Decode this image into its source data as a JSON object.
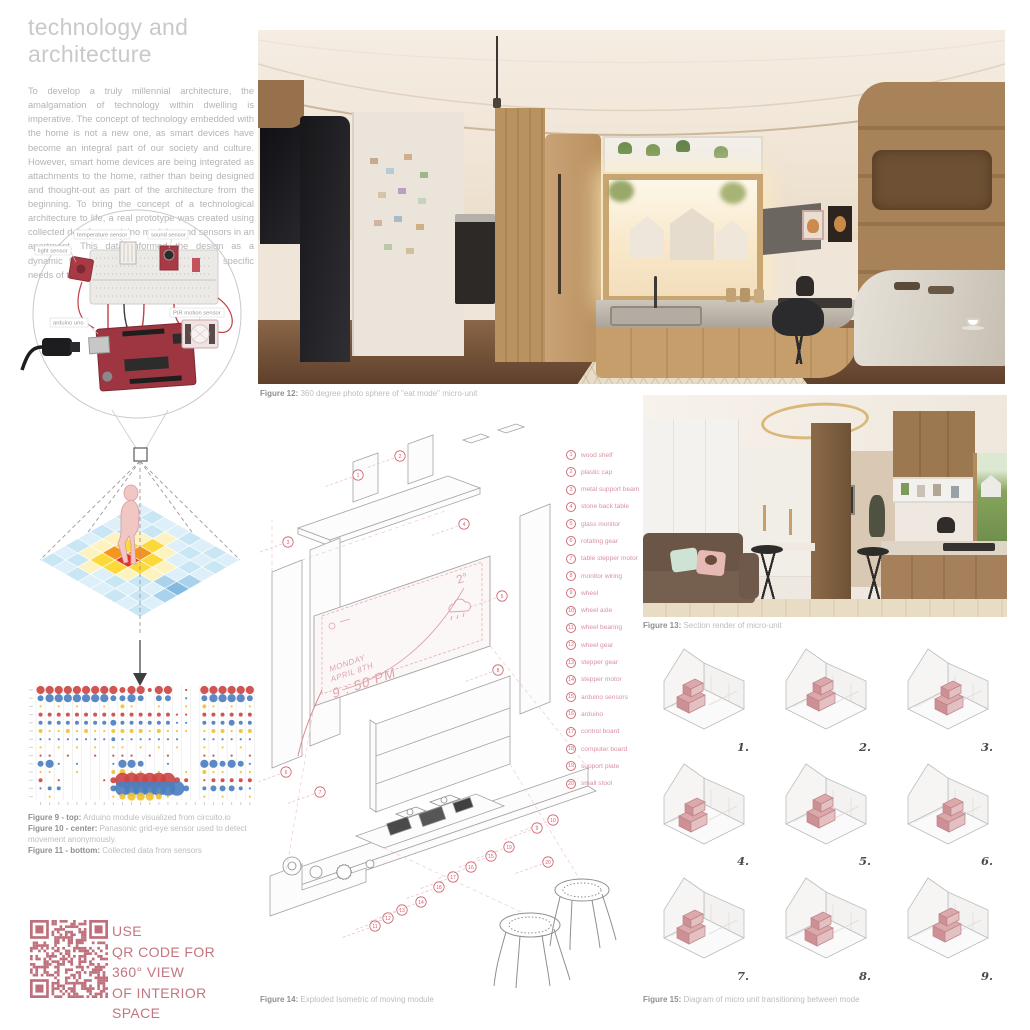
{
  "intro": {
    "title": "technology and architecture",
    "body": "To develop a truly millennial architecture, the amalgamation of technology within dwelling is imperative. The concept of technology embedded with the home is not a new one, as smart devices have become an integral part of our society and culture. However, smart home devices are being integrated as attachments to the home, rather than being designed and thought-out as part of the architecture from the beginning. To bring  the concept of a technological architecture to life, a real prototype was created using collected data from arduino modules and sensors in an apartment. This data informed the design as a dynamic floor plan that responded to the specific needs of the user was developed from it."
  },
  "arduino_diagram": {
    "labels": {
      "light": "light sensor",
      "temperature": "temperature sensor",
      "sound": "sound sensor",
      "board": "arduino uno",
      "pir": "PIR motion sensor"
    }
  },
  "figures": {
    "fig9": {
      "label": "Figure 9 - top:",
      "text": " Arduino module visualized from circuito.io"
    },
    "fig10": {
      "label": "Figure 10 - center:",
      "text": " Panasonic grid-eye sensor used to detect movement anonymously."
    },
    "fig11": {
      "label": "Figure 11 - bottom:",
      "text": " Collected data from sensors"
    },
    "fig12": {
      "label": "Figure 12:",
      "text": " 360 degree photo sphere of \"eat mode\" micro-unit"
    },
    "fig13": {
      "label": "Figure 13:",
      "text": " Section render of micro-unit"
    },
    "fig14": {
      "label": "Figure 14:",
      "text": " Exploded Isometric of moving module"
    },
    "fig15": {
      "label": "Figure 15:",
      "text": " Diagram of micro unit transitioning between mode"
    }
  },
  "exploded": {
    "legend": [
      "wood shelf",
      "plastic cap",
      "metal support beam",
      "stone back table",
      "glass monitor",
      "rotating gear",
      "table stepper motor",
      "monitor wiring",
      "wheel",
      "wheel axle",
      "wheel bearing",
      "wheel gear",
      "stepper gear",
      "stepper motor",
      "arduino sensors",
      "arduino",
      "control board",
      "computer board",
      "support plate",
      "small stool"
    ],
    "monitor": {
      "day": "MONDAY",
      "date": "APRIL 8TH",
      "time": "9 : 50 PM",
      "temp": "2°"
    },
    "accent": "#d0616e"
  },
  "qr": {
    "lines": [
      "USE",
      "QR CODE FOR",
      "360° VIEW",
      "OF INTERIOR",
      "SPACE"
    ],
    "color": "#bf6f7b"
  },
  "unit_grid": {
    "numbers": [
      "1.",
      "2.",
      "3.",
      "4.",
      "5.",
      "6.",
      "7.",
      "8.",
      "9."
    ],
    "module_color": "#dba8ab"
  },
  "chart_data": [
    {
      "type": "heatmap",
      "title": "Grid-eye sensor movement heatmap (Figure 10)",
      "grid_on": true,
      "legend_position": "none",
      "palette": {
        "a": "#ddeff8",
        "b": "#c8e6f4",
        "c": "#a9d3ec",
        "d": "#84b9e0",
        "y": "#fdf3c0",
        "Y": "#fcd93b",
        "o": "#f5941e",
        "r": "#e53228"
      },
      "rows": [
        [
          "a",
          "b",
          "a",
          "a",
          "b",
          "a",
          "b",
          "a"
        ],
        [
          "b",
          "a",
          "b",
          "y",
          "a",
          "b",
          "a",
          "b"
        ],
        [
          "a",
          "b",
          "y",
          "Y",
          "y",
          "a",
          "b",
          "a"
        ],
        [
          "b",
          "y",
          "Y",
          "o",
          "Y",
          "y",
          "a",
          "c"
        ],
        [
          "a",
          "y",
          "o",
          "r",
          "Y",
          "y",
          "c",
          "d"
        ],
        [
          "b",
          "y",
          "Y",
          "Y",
          "y",
          "b",
          "a",
          "c"
        ],
        [
          "a",
          "b",
          "y",
          "a",
          "b",
          "a",
          "b",
          "a"
        ],
        [
          "b",
          "a",
          "b",
          "a",
          "a",
          "b",
          "a",
          "b"
        ]
      ]
    },
    {
      "type": "scatter",
      "title": "Collected data from sensors (Figure 11)",
      "x_count": 24,
      "series_colors": {
        "red": "#cc4744",
        "blue": "#4d7fc0",
        "yellow": "#f0c232"
      },
      "size_scale": [
        0,
        1.1,
        2.0,
        3.0,
        4.1,
        7.4
      ],
      "rows": [
        {
          "color": "red",
          "sizes": [
            4,
            4,
            4,
            4,
            4,
            4,
            4,
            4,
            4,
            3,
            4,
            4,
            2,
            4,
            4,
            0,
            1,
            0,
            4,
            4,
            4,
            4,
            4,
            4
          ]
        },
        {
          "color": "blue",
          "sizes": [
            3,
            4,
            4,
            4,
            4,
            4,
            4,
            4,
            3,
            3,
            4,
            3,
            0,
            3,
            3,
            0,
            1,
            0,
            3,
            4,
            4,
            4,
            4,
            3
          ]
        },
        {
          "color": "yellow",
          "sizes": [
            1,
            0,
            1,
            0,
            1,
            0,
            0,
            1,
            0,
            2,
            1,
            0,
            0,
            1,
            0,
            0,
            1,
            0,
            2,
            1,
            0,
            1,
            0,
            1
          ]
        },
        {
          "color": "red",
          "sizes": [
            2,
            2,
            2,
            2,
            2,
            2,
            2,
            2,
            2,
            2,
            2,
            2,
            2,
            2,
            2,
            1,
            1,
            0,
            2,
            2,
            2,
            2,
            2,
            2
          ]
        },
        {
          "color": "blue",
          "sizes": [
            2,
            2,
            2,
            2,
            2,
            2,
            2,
            2,
            3,
            2,
            2,
            2,
            2,
            2,
            2,
            1,
            1,
            0,
            2,
            2,
            2,
            3,
            2,
            2
          ]
        },
        {
          "color": "yellow",
          "sizes": [
            2,
            1,
            1,
            2,
            1,
            2,
            1,
            1,
            2,
            2,
            2,
            2,
            1,
            2,
            1,
            1,
            1,
            0,
            1,
            2,
            2,
            1,
            2,
            2
          ]
        },
        {
          "color": "blue",
          "sizes": [
            1,
            1,
            1,
            1,
            1,
            1,
            1,
            1,
            2,
            1,
            1,
            1,
            1,
            1,
            1,
            1,
            0,
            0,
            1,
            1,
            1,
            1,
            1,
            1
          ]
        },
        {
          "color": "yellow",
          "sizes": [
            1,
            0,
            1,
            0,
            1,
            0,
            1,
            0,
            1,
            1,
            0,
            1,
            0,
            1,
            0,
            1,
            0,
            0,
            1,
            0,
            1,
            0,
            1,
            0
          ]
        },
        {
          "color": "red",
          "sizes": [
            1,
            1,
            0,
            1,
            0,
            0,
            1,
            0,
            1,
            1,
            1,
            0,
            1,
            0,
            1,
            0,
            0,
            0,
            1,
            1,
            0,
            1,
            0,
            1
          ]
        },
        {
          "color": "blue",
          "sizes": [
            3,
            4,
            1,
            0,
            1,
            0,
            0,
            0,
            1,
            4,
            4,
            3,
            0,
            0,
            1,
            0,
            0,
            0,
            4,
            4,
            3,
            4,
            3,
            1
          ]
        },
        {
          "color": "yellow",
          "sizes": [
            1,
            1,
            0,
            0,
            1,
            0,
            0,
            0,
            2,
            3,
            1,
            1,
            0,
            1,
            0,
            0,
            1,
            0,
            2,
            1,
            1,
            0,
            1,
            1
          ]
        },
        {
          "color": "red",
          "sizes": [
            2,
            0,
            1,
            0,
            0,
            0,
            0,
            1,
            3,
            5,
            5,
            5,
            5,
            5,
            5,
            3,
            2,
            0,
            1,
            2,
            2,
            2,
            2,
            2
          ]
        },
        {
          "color": "blue",
          "sizes": [
            1,
            2,
            2,
            0,
            0,
            0,
            0,
            0,
            3,
            5,
            5,
            5,
            5,
            5,
            5,
            5,
            3,
            0,
            2,
            3,
            3,
            3,
            2,
            1
          ]
        },
        {
          "color": "yellow",
          "sizes": [
            0,
            1,
            0,
            0,
            0,
            0,
            0,
            0,
            1,
            3,
            4,
            4,
            4,
            3,
            1,
            0,
            0,
            0,
            1,
            0,
            1,
            0,
            0,
            1
          ]
        }
      ]
    }
  ]
}
